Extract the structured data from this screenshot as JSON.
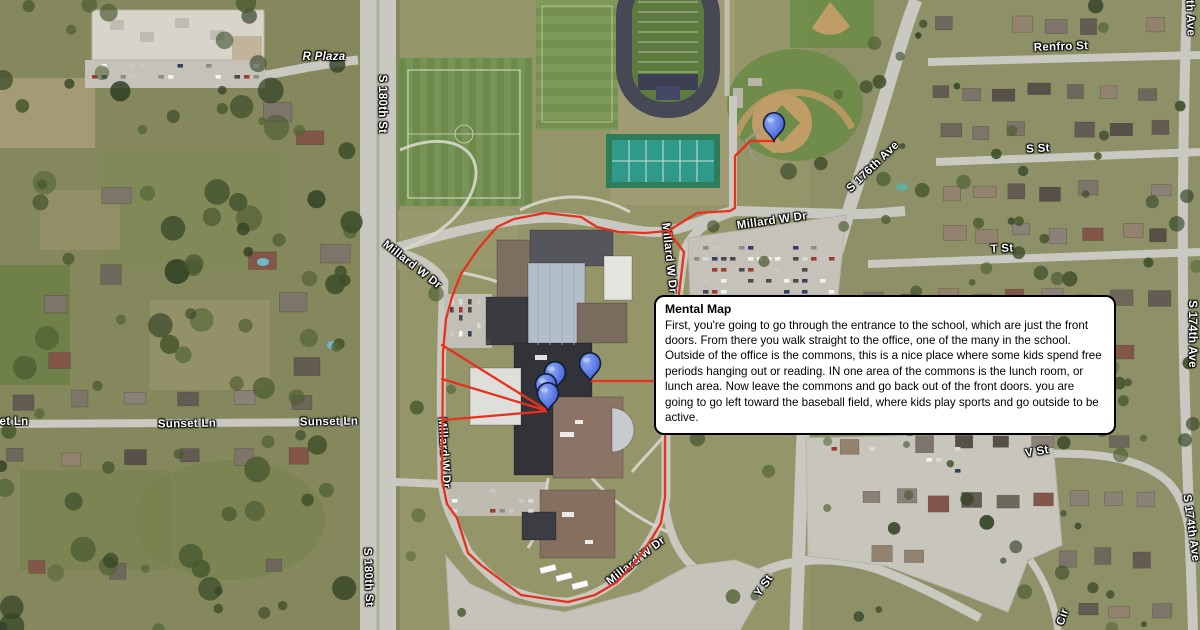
{
  "map": {
    "info_box": {
      "title": "Mental Map",
      "body": "First, you're going to go through the entrance to the school, which are just the front doors. From there you walk straight to the office, one of the many in the school. Outside of the office is the commons, this is a nice place where some kids spend free periods hanging out or reading. IN one area of the commons is the lunch room, or lunch area. Now leave the commons and go back out of the front doors. you are going to go left toward the baseball field, where kids play sports and go outside to be active."
    },
    "labels": [
      {
        "id": "r-plaza",
        "text": "R Plaza"
      },
      {
        "id": "s-180th-st-top",
        "text": "S 180th St"
      },
      {
        "id": "s-174th-ave-partial",
        "text": "th Ave"
      },
      {
        "id": "renfro-st",
        "text": "Renfro St"
      },
      {
        "id": "s-st",
        "text": "S St"
      },
      {
        "id": "s-176th-ave",
        "text": "S 176th Ave"
      },
      {
        "id": "t-st",
        "text": "T St"
      },
      {
        "id": "s-174th-ave-top",
        "text": "S 174th Ave"
      },
      {
        "id": "millard-w-dr-north",
        "text": "Millard W Dr"
      },
      {
        "id": "millard-w-dr-east",
        "text": "Millard W Dr"
      },
      {
        "id": "millard-w-dr-west",
        "text": "Millard W Dr"
      },
      {
        "id": "sunset-ln-partial",
        "text": "et Ln"
      },
      {
        "id": "sunset-ln-1",
        "text": "Sunset Ln"
      },
      {
        "id": "sunset-ln-2",
        "text": "Sunset Ln"
      },
      {
        "id": "millard-w-dr-southwest",
        "text": "Millard W Dr"
      },
      {
        "id": "v-st",
        "text": "V St"
      },
      {
        "id": "millard-w-dr-south",
        "text": "Millard W Dr"
      },
      {
        "id": "y-st",
        "text": "Y St"
      },
      {
        "id": "s-174th-ave-bottom",
        "text": "S 174th Ave"
      },
      {
        "id": "s-180th-st-bottom",
        "text": "S 180th St"
      },
      {
        "id": "cir",
        "text": "Cir"
      }
    ],
    "markers": [
      {
        "name": "baseball-field-pin"
      },
      {
        "name": "front-doors-east-pin"
      },
      {
        "name": "school-cluster-pin-1"
      },
      {
        "name": "school-cluster-pin-2"
      },
      {
        "name": "school-cluster-pin-3"
      }
    ],
    "colors": {
      "pin_blue": "#5d7de6",
      "route_red": "#e8301f",
      "road_fill": "#c9c9c1",
      "label_text": "#ffffff"
    }
  }
}
